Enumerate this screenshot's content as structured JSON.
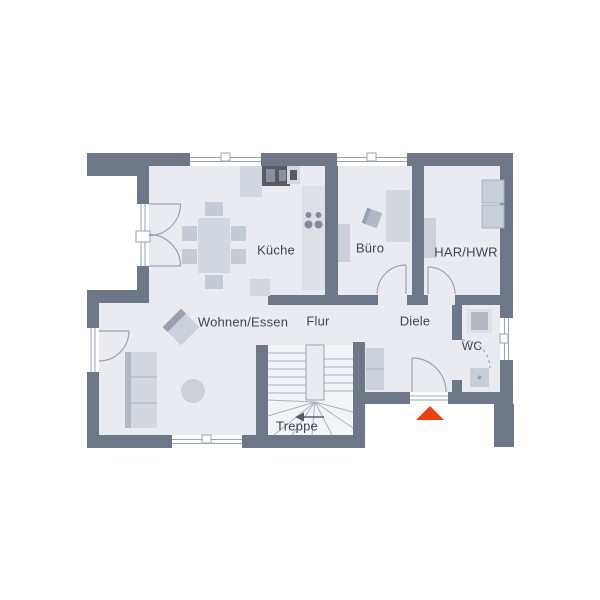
{
  "plan": {
    "labels": {
      "kueche": "Küche",
      "buero": "Büro",
      "har_hwr": "HAR/HWR",
      "wohnen_essen": "Wohnen/Essen",
      "flur": "Flur",
      "diele": "Diele",
      "wc": "WC",
      "treppe": "Treppe"
    },
    "entrance_marker": "entrance-arrow-up"
  },
  "colors": {
    "wall": "#6e7787",
    "floor": "#e9ebf0",
    "furniture": "#d3d7df",
    "furniture_dark": "#b2b8c4",
    "appliance": "#565b66",
    "door_line": "#9aa3b0",
    "label_text": "#3d4452",
    "entrance_arrow": "#e8400f"
  }
}
